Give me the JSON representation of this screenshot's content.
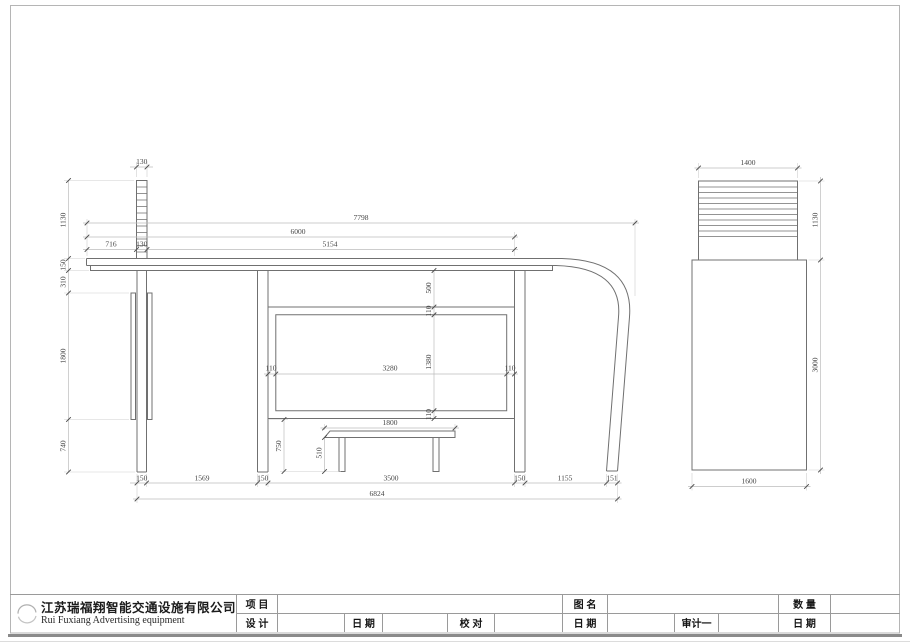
{
  "sheet": {
    "background": "#ffffff",
    "geometry_color": "#707070",
    "dimension_line_color": "#bdbdbd",
    "tick_color": "#4d4d4d",
    "text_color": "#454545",
    "border_color": "#b5b5b5"
  },
  "drawing": {
    "front": {
      "post_w": "130",
      "total_w": "7798",
      "w_6000": "6000",
      "w_5154": "5154",
      "w_716": "716",
      "post_w2": "130",
      "h_1130": "1130",
      "h_150": "150",
      "h_310": "310",
      "h_1800": "1800",
      "h_740": "740",
      "gap_500": "500",
      "frame_110_top": "110",
      "board_h_1380": "1380",
      "frame_110_bot": "110",
      "frame_110_left": "110",
      "board_w_3280": "3280",
      "frame_110_right": "110",
      "bench_w_1800": "1800",
      "h_750": "750",
      "bench_h_510": "510",
      "b150a": "150",
      "b1569": "1569",
      "b150b": "150",
      "b3500": "3500",
      "b150c": "150",
      "b1155": "1155",
      "b151": "151",
      "total_6824": "6824"
    },
    "side": {
      "w_1400": "1400",
      "h_1130": "1130",
      "h_3000": "3000",
      "w_1600": "1600"
    }
  },
  "title_block": {
    "company_cn": "江苏瑞福翔智能交通设施有限公司",
    "company_en": "Rui Fuxiang Advertising equipment",
    "labels": {
      "project": "项 目",
      "design": "设 计",
      "date": "日 期",
      "check": "校 对",
      "drawing_name": "图 名",
      "quantity": "数 量",
      "audit": "审计一"
    }
  }
}
